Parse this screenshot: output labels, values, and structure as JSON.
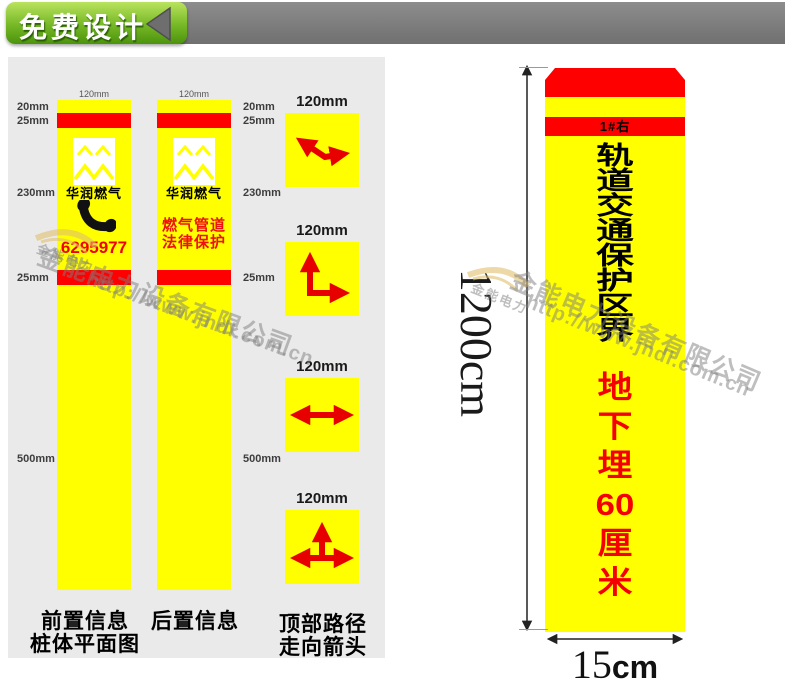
{
  "banner": {
    "ribbon_label": "免费设计"
  },
  "colors": {
    "post_yellow": "#ffff00",
    "band_red": "#fe0000",
    "ribbon_green": "#76b826",
    "panel_gray": "#eaeaea",
    "banner_gray": "#7a7a7a"
  },
  "panel": {
    "dim_labels": [
      "20mm",
      "25mm",
      "230mm",
      "25mm",
      "500mm"
    ],
    "posts": [
      {
        "width_label": "120mm",
        "brand": "华润燃气",
        "phone": "6295977"
      },
      {
        "width_label": "120mm",
        "brand": "华润燃气",
        "slogan_line1": "燃气管道",
        "slogan_line2": "法律保护"
      }
    ],
    "squares": [
      {
        "label": "120mm"
      },
      {
        "label": "120mm"
      },
      {
        "label": "120mm"
      },
      {
        "label": "120mm"
      }
    ],
    "captions": [
      {
        "line1": "前置信息",
        "line2": "桩体平面图"
      },
      {
        "line1": "后置信息"
      },
      {
        "line1": "顶部路径",
        "line2": "走向箭头"
      }
    ]
  },
  "marker": {
    "plate_label": "1#右",
    "title_chars": [
      "轨",
      "道",
      "交",
      "通",
      "保",
      "护",
      "区",
      "界"
    ],
    "subtitle_chars": [
      "地",
      "下",
      "埋",
      "60",
      "厘",
      "米"
    ],
    "height_label": "1200cm",
    "width_value": "15",
    "width_unit": "cm"
  },
  "watermark": {
    "brand": "金能电力",
    "company": "金能电力设备有限公司",
    "url": "http://www.jndl.com.cn"
  }
}
